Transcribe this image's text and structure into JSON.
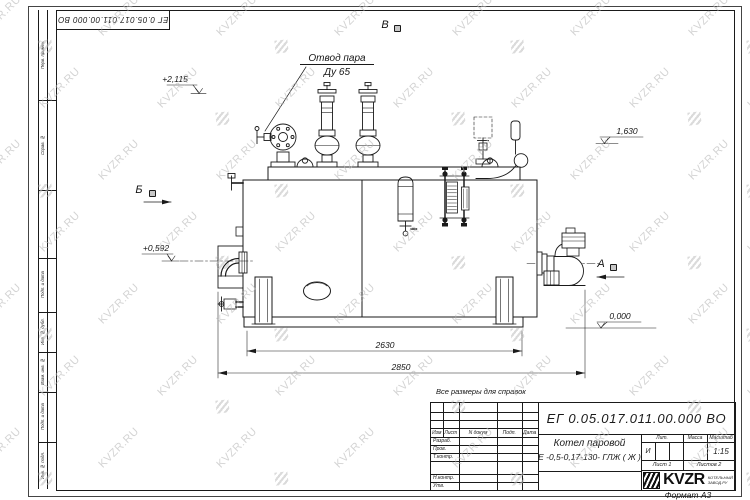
{
  "sheet": {
    "stamp": "ЕГ 0.05.017.011.00.000  ВО",
    "format_note": "Формат А3",
    "side_labels": [
      "Перв. примен.",
      "Справ. №",
      "Подп. и дата",
      "Инв. № дубл.",
      "Взам. инв. №",
      "Подп. и дата",
      "Инв. № подл."
    ]
  },
  "watermark": {
    "text": "KVZR.RU"
  },
  "drawing": {
    "steam_label_line1": "Отвод пара",
    "steam_label_line2": "Ду 65",
    "view_b": "Б",
    "view_v": "В",
    "view_a": "А",
    "elev_top": "+2,115",
    "elev_right_top": "1,630",
    "elev_burner": "+0,592",
    "elev_zero": "0,000",
    "dim_inner": "2630",
    "dim_overall": "2850",
    "note": "Все размеры для справок"
  },
  "title_block": {
    "doc_number": "ЕГ 0.05.017.011.00.000  ВО",
    "product_name": "Котел паровой",
    "product_type": "Е -0,5-0,17-130- ГЛЖ ( Ж )",
    "col_izm": "Изм",
    "col_list": "Лист",
    "col_ndoc": "N докум",
    "col_podp": "Подп.",
    "col_data": "Дата",
    "row_razrab": "Разраб.",
    "row_prov": "Пров.",
    "row_tkontr": "Т.контр.",
    "row_nkontr": "Н.контр.",
    "row_utv": "Утв.",
    "lit_header": "Лит.",
    "mass_header": "Масса",
    "scale_header": "Масштаб",
    "lit_value": "И",
    "scale_value": "1:15",
    "sheet_no": "Лист 1",
    "sheets_total": "Листов 2",
    "logo": "KVZR",
    "logo_sub1": "КОТЕЛЬНЫЙ",
    "logo_sub2": "ЗАВОД.РУ"
  }
}
